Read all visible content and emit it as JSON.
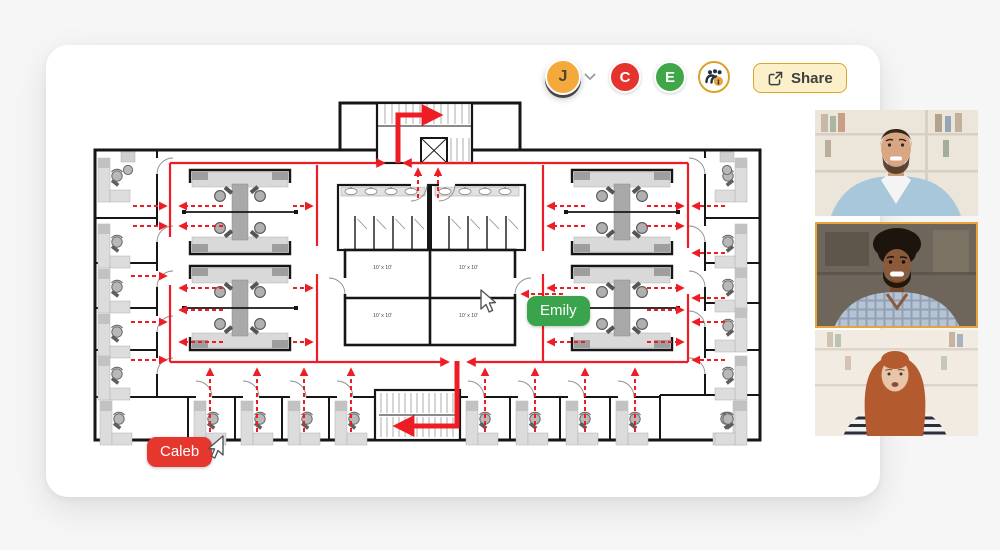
{
  "toolbar": {
    "user_avatar": {
      "initial": "J",
      "color": "#F4A93C"
    },
    "collaborators": [
      {
        "initial": "C",
        "color": "#E5342E"
      },
      {
        "initial": "E",
        "color": "#3FA748"
      }
    ],
    "participants_button": {
      "icon": "people-group-info-icon",
      "ring_color": "#D9A32A",
      "badge_color": "#E8A33D"
    },
    "share_button": {
      "label": "Share",
      "bg": "#FBF0C9",
      "border": "#D9A826"
    }
  },
  "canvas": {
    "plan": {
      "room_label": "10' x 10'",
      "route_color": "#EE1C25",
      "wall_color": "#161616"
    },
    "cursors": [
      {
        "name": "Emily",
        "color": "#3AA44C"
      },
      {
        "name": "Caleb",
        "color": "#E5372E"
      }
    ]
  },
  "video_call": {
    "tiles": [
      {
        "active": false
      },
      {
        "active": true,
        "highlight_color": "#E8A33D"
      },
      {
        "active": false
      }
    ]
  }
}
